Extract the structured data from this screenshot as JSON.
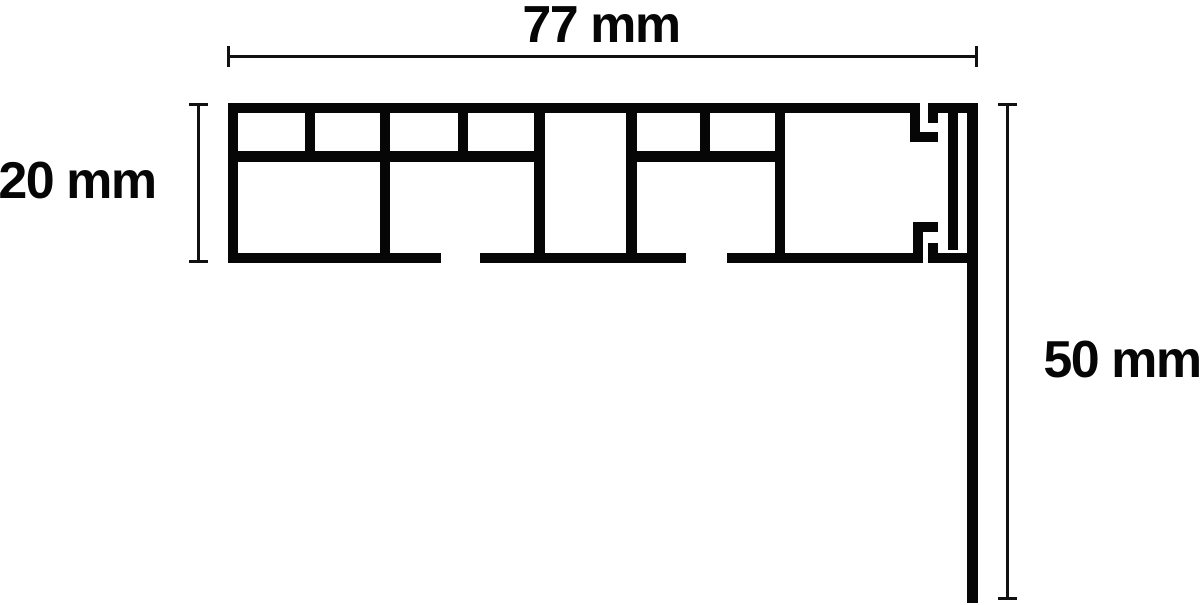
{
  "diagram": {
    "type": "technical-cross-section",
    "subject": "multi-chamber profile cross-section with drop leg",
    "colors": {
      "line": "#060606",
      "background": "#ffffff"
    },
    "dimensions": {
      "width": {
        "label": "77 mm",
        "value_mm": 77,
        "position": "top"
      },
      "height": {
        "label": "20 mm",
        "value_mm": 20,
        "position": "left"
      },
      "drop": {
        "label": "50 mm",
        "value_mm": 50,
        "position": "right"
      }
    }
  }
}
